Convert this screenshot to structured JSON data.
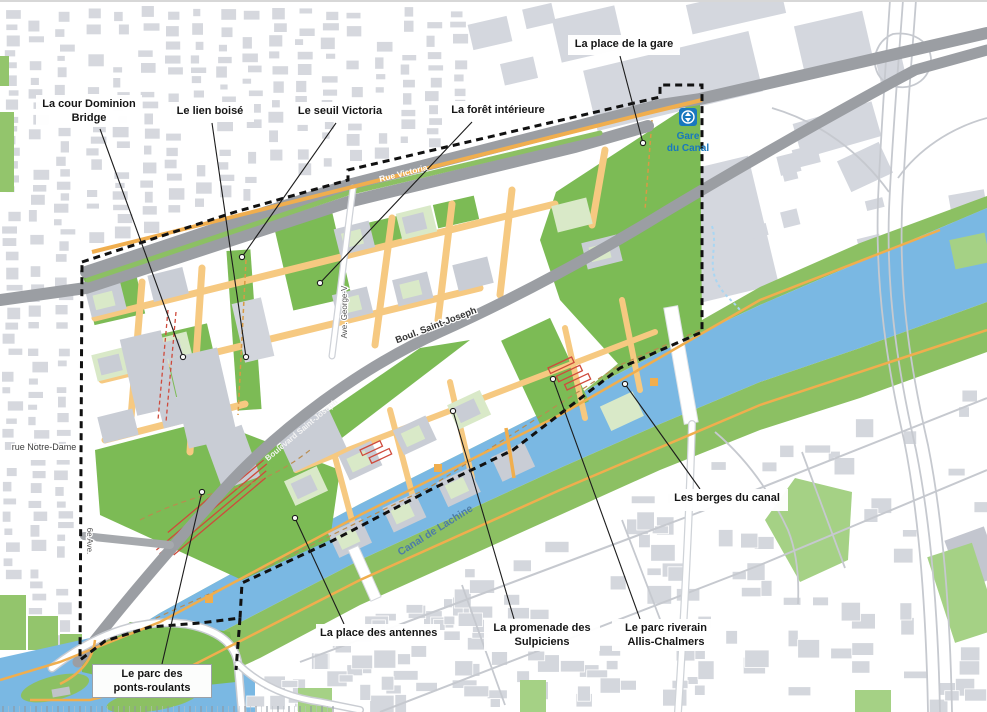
{
  "map": {
    "description": "Plan d'ensemble du secteur du canal de Lachine avec périmètre d'intervention en pointillé",
    "callouts": [
      {
        "id": "cour-dominion-bridge",
        "lines": [
          "La cour Dominion",
          "Bridge"
        ],
        "box": [
          36,
          95,
          106,
          32
        ],
        "anchor": [
          100,
          129
        ],
        "target": [
          183,
          357
        ],
        "bordered": false
      },
      {
        "id": "lien-boise",
        "lines": [
          "Le lien boisé"
        ],
        "box": [
          166,
          102,
          88,
          20
        ],
        "anchor": [
          212,
          123
        ],
        "target": [
          246,
          357
        ],
        "bordered": false
      },
      {
        "id": "seuil-victoria",
        "lines": [
          "Le seuil Victoria"
        ],
        "box": [
          292,
          102,
          96,
          20
        ],
        "anchor": [
          336,
          123
        ],
        "target": [
          242,
          257
        ],
        "bordered": false
      },
      {
        "id": "foret-interieure",
        "lines": [
          "La forêt intérieure"
        ],
        "box": [
          446,
          101,
          104,
          20
        ],
        "anchor": [
          472,
          122
        ],
        "target": [
          320,
          283
        ],
        "bordered": false
      },
      {
        "id": "place-de-la-gare",
        "lines": [
          "La place de la gare"
        ],
        "box": [
          568,
          35,
          112,
          20
        ],
        "anchor": [
          620,
          56
        ],
        "target": [
          643,
          143
        ],
        "bordered": false
      },
      {
        "id": "berges-du-canal",
        "lines": [
          "Les berges du canal"
        ],
        "box": [
          666,
          489,
          122,
          22
        ],
        "anchor": [
          700,
          489
        ],
        "target": [
          625,
          384
        ],
        "bordered": false
      },
      {
        "id": "place-des-antennes",
        "lines": [
          "La place des antennes"
        ],
        "box": [
          316,
          624,
          124,
          22
        ],
        "anchor": [
          344,
          624
        ],
        "target": [
          295,
          518
        ],
        "bordered": false
      },
      {
        "id": "promenade-des-sulpiciens",
        "lines": [
          "La promenade des",
          "Sulpiciens"
        ],
        "box": [
          484,
          619,
          116,
          32
        ],
        "anchor": [
          514,
          619
        ],
        "target": [
          453,
          411
        ],
        "bordered": false
      },
      {
        "id": "parc-riverain-allis-chalmers",
        "lines": [
          "Le parc riverain",
          "Allis-Chalmers"
        ],
        "box": [
          612,
          619,
          108,
          32
        ],
        "anchor": [
          640,
          619
        ],
        "target": [
          553,
          379
        ],
        "bordered": false
      },
      {
        "id": "parc-des-ponts-roulants",
        "lines": [
          "Le parc des",
          "ponts-roulants"
        ],
        "box": [
          92,
          664,
          120,
          33
        ],
        "anchor": [
          162,
          664
        ],
        "target": [
          202,
          492
        ],
        "bordered": true
      }
    ],
    "street_labels": [
      {
        "id": "rue-victoria",
        "text": "Rue Victoria",
        "x": 404,
        "y": 176,
        "rot": -14,
        "size": 8.5,
        "color": "#ffffff",
        "weight": 700,
        "halo": false
      },
      {
        "id": "boulevard-saint-joseph-on-road",
        "text": "Boulevard Saint-Joseph",
        "x": 303,
        "y": 432,
        "rot": -40,
        "size": 8,
        "color": "#f4f4f4",
        "weight": 700,
        "halo": false
      },
      {
        "id": "boul-saint-joseph",
        "text": "Boul. Saint-Joseph",
        "x": 437,
        "y": 328,
        "rot": -21,
        "size": 9.5,
        "color": "#333333",
        "weight": 700,
        "halo": true
      },
      {
        "id": "rue-notre-dame",
        "text": "rue Notre-Dame",
        "x": 44,
        "y": 450,
        "rot": 0,
        "size": 9,
        "color": "#3c3c3c",
        "weight": 400,
        "halo": true
      },
      {
        "id": "sixieme-ave",
        "text": "6e Ave.",
        "x": 87,
        "y": 541,
        "rot": 90,
        "size": 8,
        "color": "#555555",
        "weight": 400,
        "halo": true
      },
      {
        "id": "ave-george-v",
        "text": "Ave. George-V",
        "x": 347,
        "y": 312,
        "rot": -90,
        "size": 8,
        "color": "#555555",
        "weight": 400,
        "halo": true
      },
      {
        "id": "canal-de-lachine",
        "text": "Canal de Lachine",
        "x": 437,
        "y": 533,
        "rot": -32,
        "size": 10.5,
        "color": "#4d7ca6",
        "weight": 700,
        "halo": false
      }
    ],
    "station": {
      "icon": "train-station-icon",
      "lines": [
        "Gare",
        "du Canal"
      ],
      "x": 688,
      "y": 127,
      "color": "#1878be"
    },
    "colors": {
      "water": "#7ab8e3",
      "bank_green": "#8cc063",
      "park_green": "#7cbb55",
      "pale_block": "#d9e9c8",
      "building_gray": "#c9cdd5",
      "residential_gray": "#d6d8de",
      "road_gray": "#9b9ea3",
      "street_orange": "#f6c981",
      "path_orange": "#f0ae4e",
      "boundary": "#111111",
      "red_rail": "#cf4a3c",
      "leader": "#1c1c1c",
      "station_blue": "#1878be"
    }
  }
}
